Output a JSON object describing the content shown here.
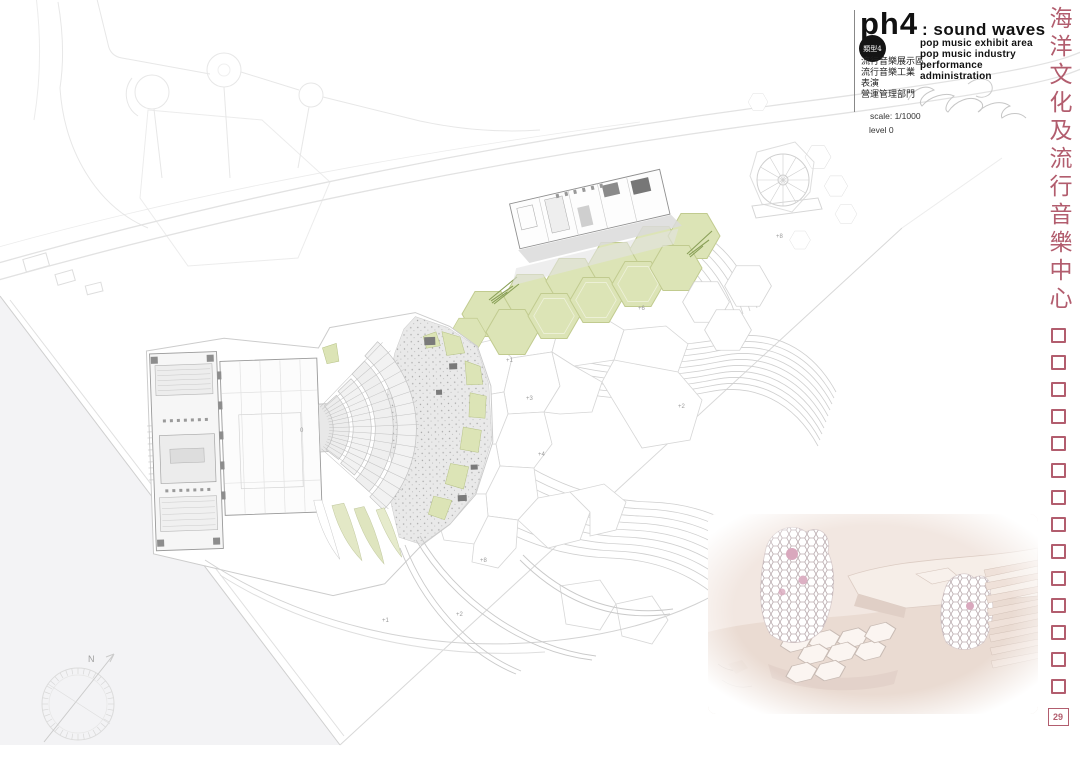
{
  "title_block": {
    "code": "ph4",
    "title": ": sound waves",
    "badge_label": "類型4",
    "program_en": [
      "pop music exhibit area",
      "pop music industry",
      "performance",
      "administration"
    ],
    "program_zh": [
      "流行音樂展示區",
      "流行音樂工業",
      "表演",
      "營運管理部門"
    ],
    "scale_label": "scale: 1/1000",
    "level_label": "level 0"
  },
  "sidebar": {
    "title_vertical": "海洋文化及流行音樂中心",
    "placeholder_square_count": 14,
    "page_number": "29",
    "accent_color": "#b25d6e"
  },
  "plan": {
    "north_label": "N",
    "green_color": "#dce4b6",
    "labels": [
      {
        "text": "+1"
      },
      {
        "text": "+3"
      },
      {
        "text": "+4"
      },
      {
        "text": "+2"
      },
      {
        "text": "+6"
      },
      {
        "text": "+8"
      },
      {
        "text": "+1"
      },
      {
        "text": "+2"
      },
      {
        "text": "+8"
      },
      {
        "text": "0"
      }
    ]
  },
  "render_photo": {
    "background_color": "#f2e7e1",
    "accent_pink": "#d9a8bd"
  }
}
